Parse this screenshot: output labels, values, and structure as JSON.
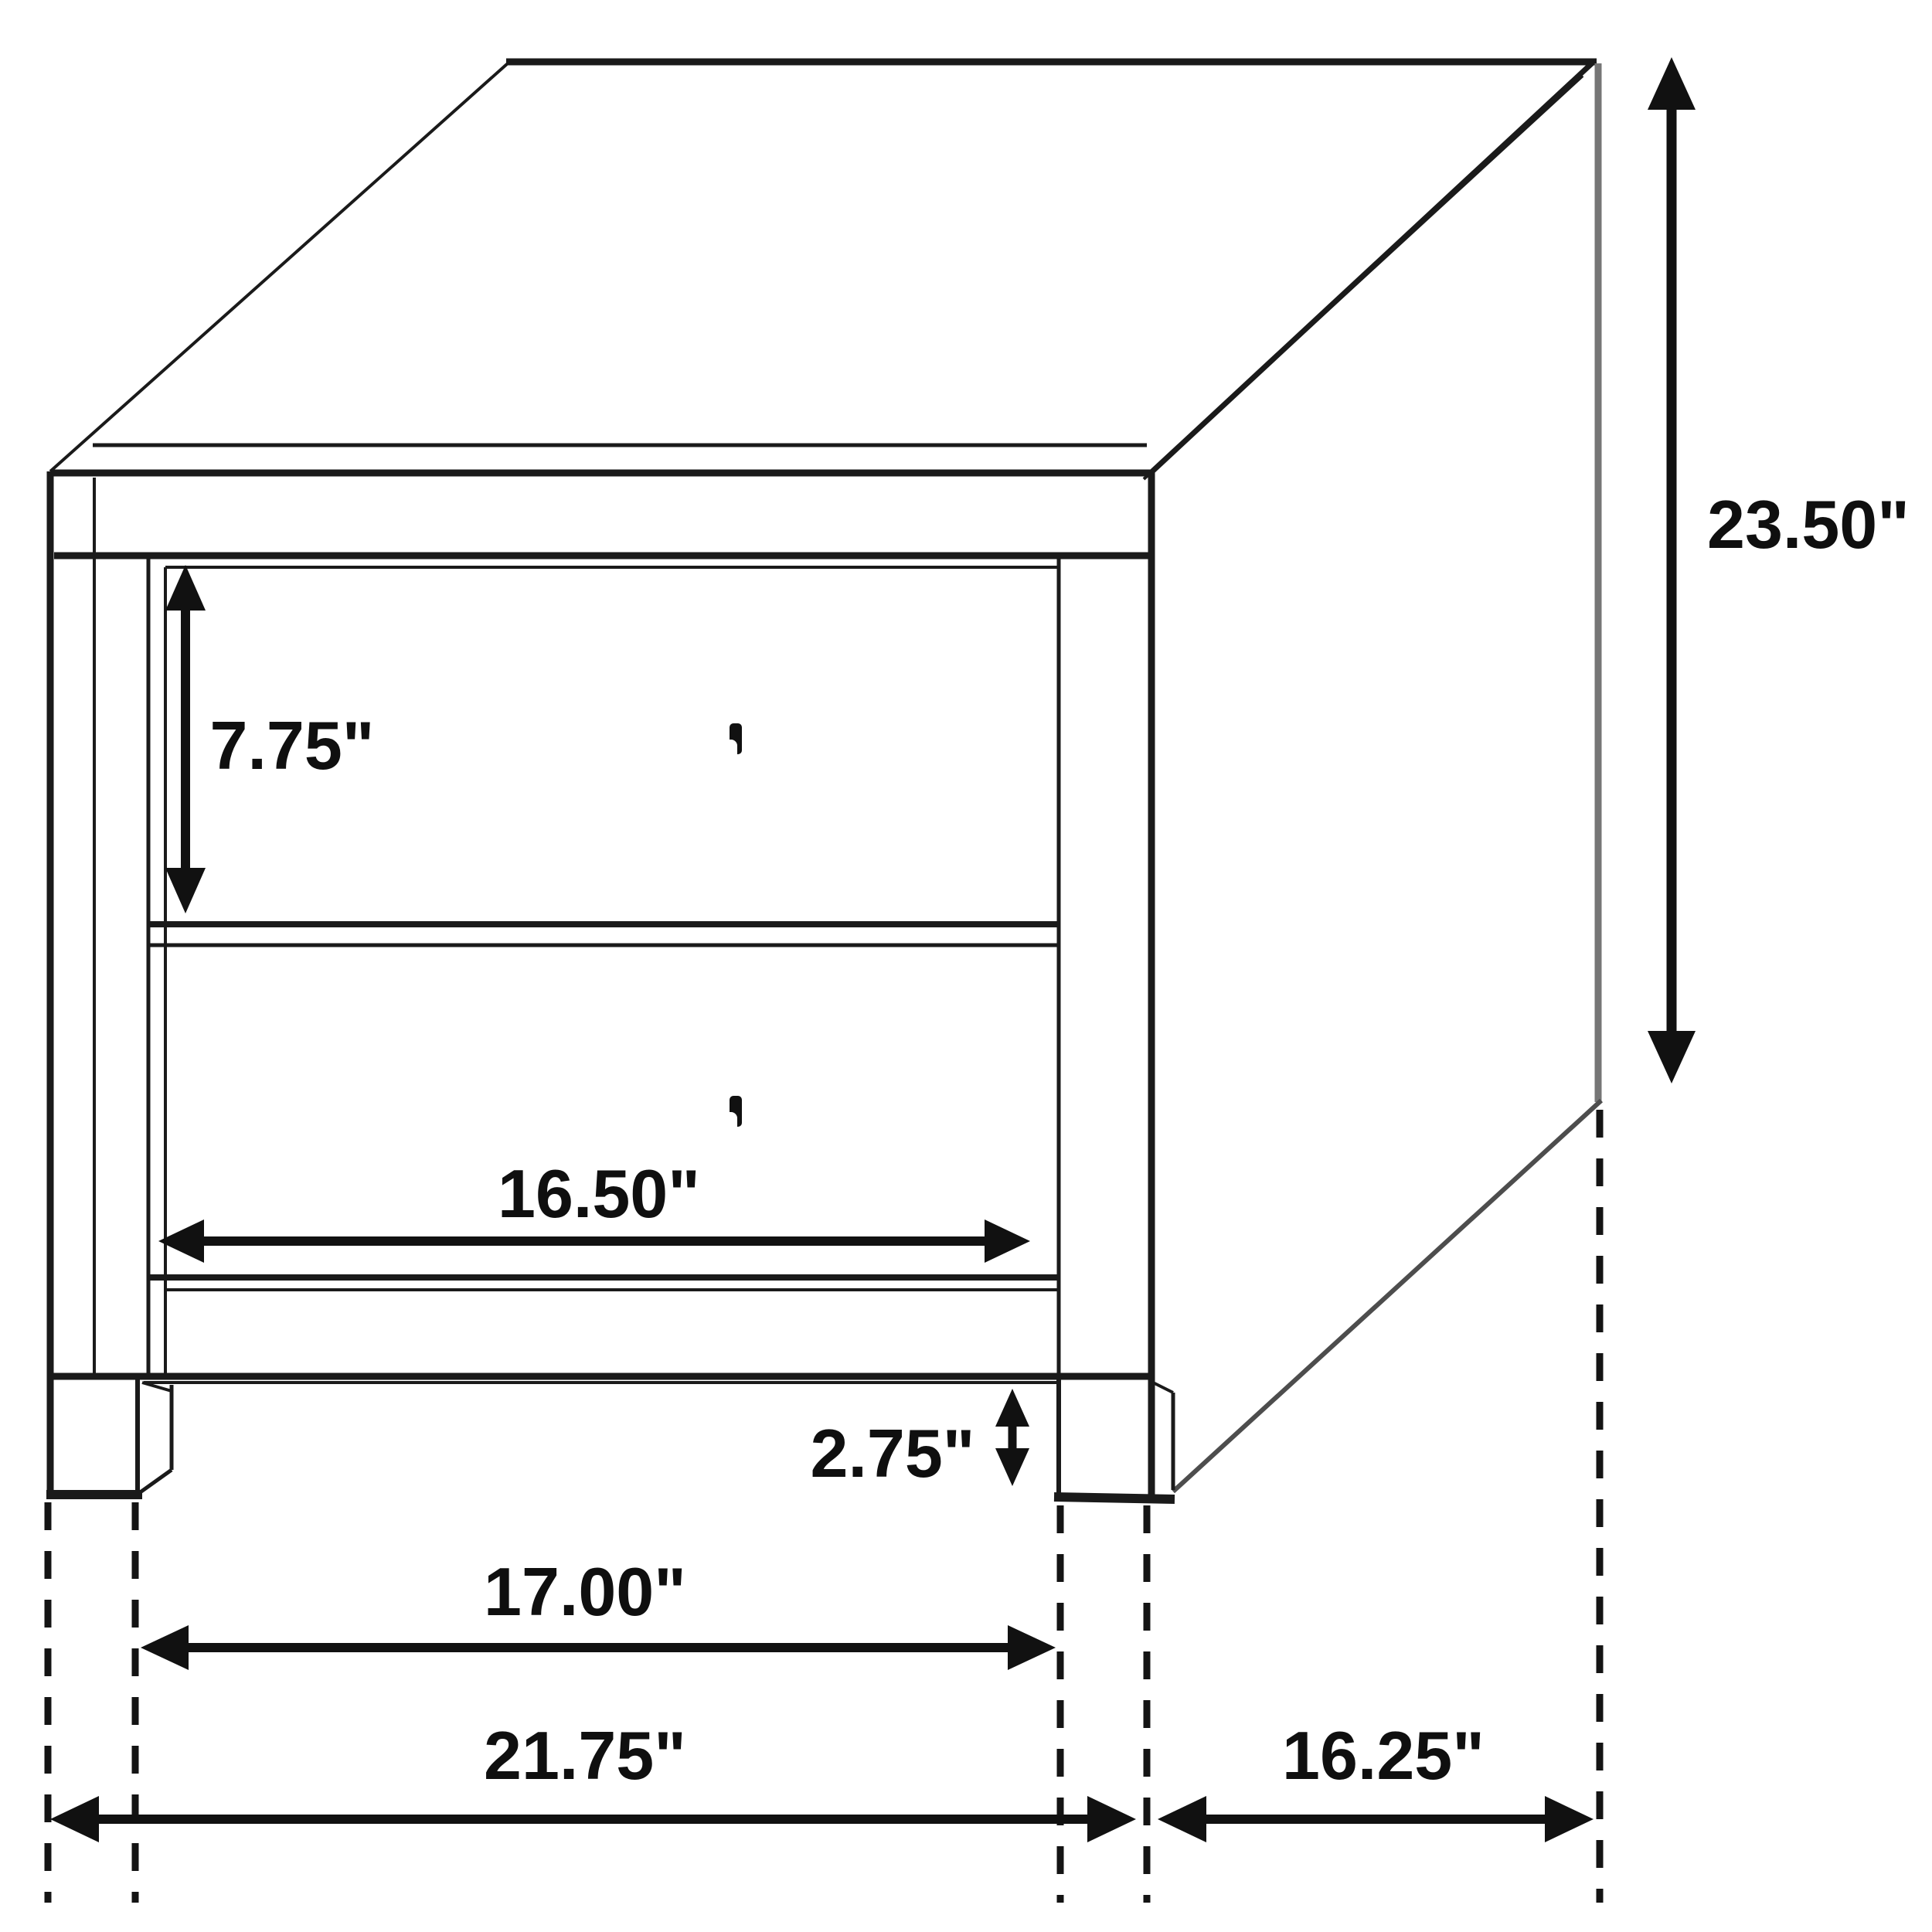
{
  "diagram": {
    "object": "two-drawer-nightstand-dimension-drawing",
    "background": "#ffffff",
    "line_color": "#1a1a1a",
    "units": "inches",
    "dims": {
      "drawer_front_height": "7.75\"",
      "drawer_width": "16.50\"",
      "leg_height": "2.75\"",
      "width_between_legs": "17.00\"",
      "overall_width": "21.75\"",
      "depth": "16.25\"",
      "overall_height": "23.50\""
    }
  }
}
